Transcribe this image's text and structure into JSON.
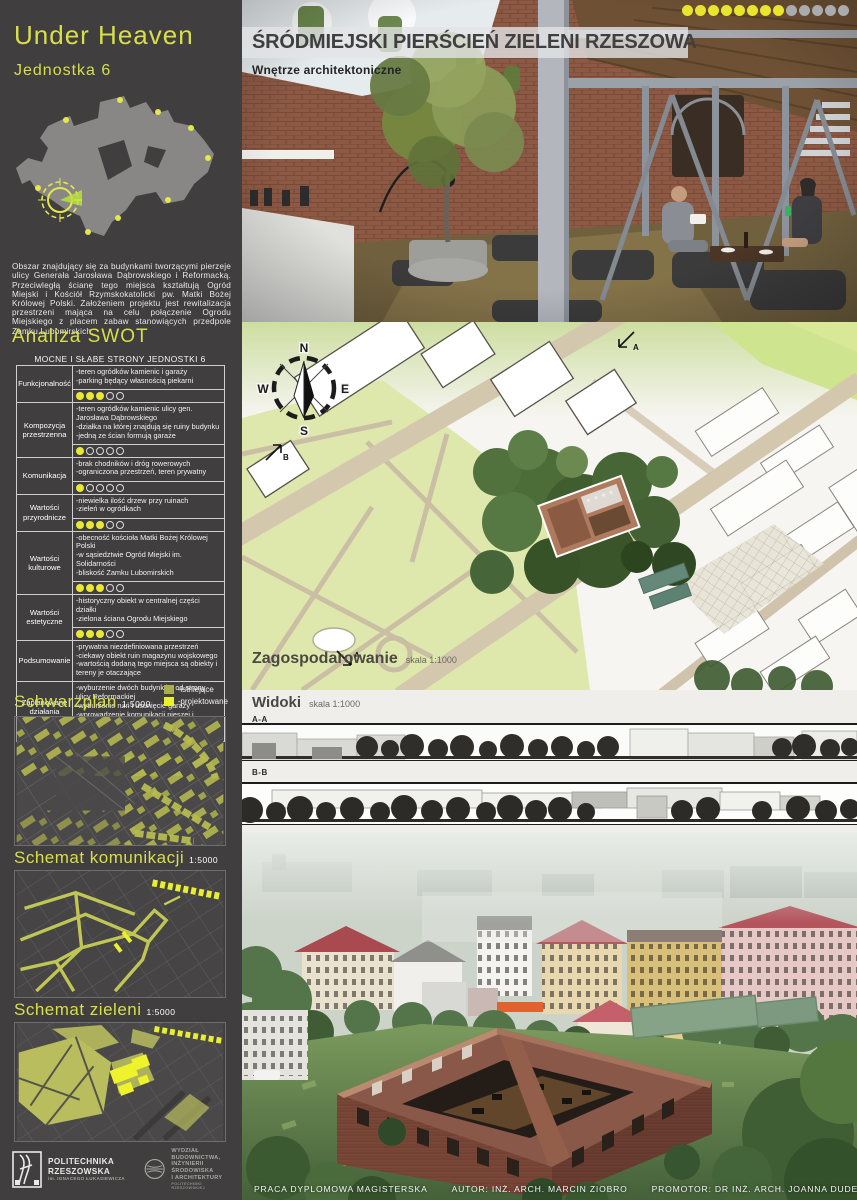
{
  "colors": {
    "accent_yellow": "#d9df49",
    "score_yellow": "#eae636",
    "legend_existing": "#a9ad4b",
    "legend_planned": "#eaf02c",
    "sidebar_bg": "#403e3f",
    "brick": "#7d4a3c"
  },
  "sidebar": {
    "title": "Under Heaven",
    "subtitle": "Jednostka 6",
    "intro": "Obszar znajdujący się za budynkami tworzącymi pierzeje ulicy Generała Jarosława Dąbrowskiego i Reformacką. Przeciwległą ścianę tego miejsca kształtują Ogród Miejski i Kościół Rzymskokatolicki pw. Matki Bożej Królowej Polski. Założeniem projektu jest rewitalizacja przestrzeni mająca na celu połączenie Ogrodu Miejskiego z placem zabaw stanowiących przedpole Zamku Lubomirskich.",
    "swot_heading": "Analiza SWOT",
    "table": {
      "title": "MOCNE I SŁABE STRONY JEDNOSTKI 6",
      "rows": [
        {
          "label": "Funkcjonalność",
          "items": [
            "-teren ogródków kamienic i garaży",
            "-parking będący własnością piekarni"
          ],
          "score": 3,
          "max": 5
        },
        {
          "label": "Kompozycja przestrzenna",
          "items": [
            "-teren ogródków kamienic ulicy gen. Jarosława Dąbrowskiego",
            "-działka na której znajdują się ruiny budynku",
            "-jedną ze ścian formują garaże"
          ],
          "score": 1,
          "max": 5
        },
        {
          "label": "Komunikacja",
          "items": [
            "-brak chodników i dróg rowerowych",
            "-ograniczona przestrzeń, teren prywatny"
          ],
          "score": 1,
          "max": 5
        },
        {
          "label": "Wartości przyrodnicze",
          "items": [
            "-niewielka ilość drzew przy ruinach",
            "-zieleń w ogródkach"
          ],
          "score": 3,
          "max": 5
        },
        {
          "label": "Wartości kulturowe",
          "items": [
            "-obecność kościoła Matki Bożej Królowej Polski",
            "-w sąsiedztwie Ogród Miejski im. Solidarności",
            "-bliskość Zamku Lubomirskich"
          ],
          "score": 3,
          "max": 5
        },
        {
          "label": "Wartości estetyczne",
          "items": [
            "-historyczny obiekt w centralnej części działki",
            "-zielona ściana Ogrodu Miejskiego"
          ],
          "score": 3,
          "max": 5
        },
        {
          "label": "Podsumowanie",
          "items": [
            "-prywatna niezdefiniowana przestrzeń",
            "-ciekawy obiekt ruin magazynu wojskowego",
            "-wartością dodaną tego miejsca są obiekty i tereny je otaczające"
          ],
          "score": null,
          "max": 5
        },
        {
          "label": "Zaplanowane działania naprawcze",
          "items": [
            "-wyburzenie dwóch budynków od strony ulicy Reformackiej",
            "-wyburzenie ruin i usunięcie garaży",
            "-wprowadzenie komunikacji pieszej i rowerowej",
            "-wprowadzenie bioróżnorodności"
          ],
          "score": null,
          "max": 5
        }
      ]
    },
    "legend": [
      {
        "label": "-istniejące",
        "color": "#a9ad4b"
      },
      {
        "label": "-projektowane",
        "color": "#eaf02c"
      }
    ],
    "maps": [
      {
        "heading": "Schwarzplan",
        "scale": "1:5000"
      },
      {
        "heading": "Schemat komunikacji",
        "scale": "1:5000"
      },
      {
        "heading": "Schemat zieleni",
        "scale": "1:5000"
      }
    ],
    "logos": {
      "university": "POLITECHNIKA RZESZOWSKA",
      "university_sub": "im. IGNACEGO ŁUKASIEWICZA",
      "faculty_l1": "WYDZIAŁ",
      "faculty_l2": "BUDOWNICTWA,",
      "faculty_l3": "INŻYNIERII ŚRODOWISKA",
      "faculty_l4": "I ARCHITEKTURY",
      "faculty_sub": "POLITECHNIKI RZESZOWSKIEJ"
    }
  },
  "main": {
    "title": "ŚRÓDMIEJSKI PIERŚCIEŃ ZIELENI RZESZOWA",
    "subtitle": "Wnętrze architektoniczne",
    "progress_dots": {
      "filled": 8,
      "total": 13
    },
    "plan": {
      "heading": "Zagospodarowanie",
      "scale": "skala 1:1000",
      "compass": {
        "n": "N",
        "e": "E",
        "s": "S",
        "w": "W"
      },
      "marker_a": "A",
      "marker_b": "B"
    },
    "views": {
      "heading": "Widoki",
      "scale": "skala 1:1000",
      "section_a": "A-A",
      "section_b": "B-B"
    },
    "footer": {
      "project": "PRACA DYPLOMOWA MAGISTERSKA",
      "author": "AUTOR: INŻ. ARCH. MARCIN ZIOBRO",
      "promoter": "PROMOTOR: DR INŻ. ARCH. JOANNA DUDEK"
    }
  }
}
